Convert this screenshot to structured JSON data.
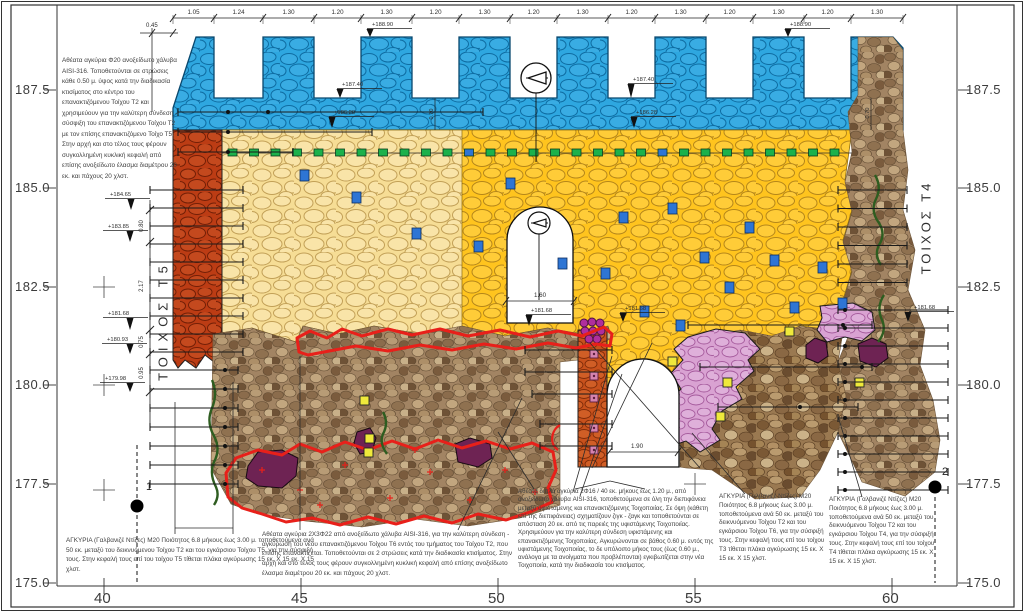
{
  "drawing": {
    "type": "wall elevation restoration drawing",
    "wall_labels": {
      "left": "ΤΟΙΧΟΣ Τ5",
      "right": "ΤΟΙΧΟΣ Τ4"
    },
    "section_markers": [
      {
        "label": "1"
      },
      {
        "label": "2"
      }
    ]
  },
  "axes": {
    "left": [
      {
        "t": "187.5",
        "y": 90
      },
      {
        "t": "185.0",
        "y": 188
      },
      {
        "t": "182.5",
        "y": 287
      },
      {
        "t": "180.0",
        "y": 385
      },
      {
        "t": "177.5",
        "y": 484
      },
      {
        "t": "175.0",
        "y": 583
      }
    ],
    "right": [
      {
        "t": "187.5",
        "y": 90
      },
      {
        "t": "185.0",
        "y": 188
      },
      {
        "t": "182.5",
        "y": 287
      },
      {
        "t": "180.0",
        "y": 385
      },
      {
        "t": "177.5",
        "y": 484
      },
      {
        "t": "175.0",
        "y": 583
      }
    ],
    "bottom": [
      {
        "t": "40",
        "x": 104
      },
      {
        "t": "45",
        "x": 301
      },
      {
        "t": "50",
        "x": 498
      },
      {
        "t": "55",
        "x": 695
      },
      {
        "t": "60",
        "x": 892
      }
    ]
  },
  "top_dimension_row": {
    "y": 18,
    "start_x": 173,
    "segments": [
      {
        "t": "1.05",
        "w": 41
      },
      {
        "t": "1.24",
        "w": 49
      },
      {
        "t": "1.30",
        "w": 51
      },
      {
        "t": "1.20",
        "w": 47
      },
      {
        "t": "1.30",
        "w": 51
      },
      {
        "t": "1.20",
        "w": 47
      },
      {
        "t": "1.30",
        "w": 51
      },
      {
        "t": "1.20",
        "w": 47
      },
      {
        "t": "1.30",
        "w": 51
      },
      {
        "t": "1.20",
        "w": 47
      },
      {
        "t": "1.30",
        "w": 51
      },
      {
        "t": "1.20",
        "w": 47
      },
      {
        "t": "1.30",
        "w": 51
      },
      {
        "t": "1.20",
        "w": 47
      },
      {
        "t": "1.30",
        "w": 52
      }
    ]
  },
  "misc_dims": {
    "d045": {
      "t": "0.45",
      "x": 146,
      "y": 27
    },
    "d160": {
      "t": "1.60",
      "x": 540,
      "y": 297,
      "x1": 506,
      "x2": 574,
      "ly": 301
    },
    "d190": {
      "t": "1.90",
      "x": 637,
      "y": 448,
      "x1": 609,
      "x2": 678,
      "ly": 452
    },
    "d070a": {
      "t": "0.70",
      "x": 433,
      "y": 114
    },
    "d070b": {
      "t": "0.70",
      "x": 869,
      "y": 113
    }
  },
  "left_dim_chain": {
    "x": 150,
    "y_top": 200,
    "y_bot": 424,
    "ticks": [
      210,
      242,
      330,
      354,
      392
    ],
    "labels": [
      {
        "t": "0.80",
        "y": 226
      },
      {
        "t": "2.17",
        "y": 286
      },
      {
        "t": "0.75",
        "y": 342
      },
      {
        "t": "0.95",
        "y": 373
      }
    ]
  },
  "elevation_markers": [
    {
      "t": "+188.90",
      "x": 372,
      "y": 26,
      "ax": 370,
      "ay": 37
    },
    {
      "t": "+188.90",
      "x": 790,
      "y": 26,
      "ax": 788,
      "ay": 37
    },
    {
      "t": "+187.40",
      "x": 342,
      "y": 86,
      "ax": 340,
      "ay": 98
    },
    {
      "t": "+187.40",
      "x": 633,
      "y": 81,
      "ax": 631,
      "ay": 98
    },
    {
      "t": "+186.28",
      "x": 334,
      "y": 114,
      "ax": 332,
      "ay": 128
    },
    {
      "t": "+186.28",
      "x": 636,
      "y": 114,
      "ax": 634,
      "ay": 128
    },
    {
      "t": "+184.65",
      "x": 110,
      "y": 196,
      "ax": 131,
      "ay": 210
    },
    {
      "t": "+183.85",
      "x": 108,
      "y": 228,
      "ax": 130,
      "ay": 242
    },
    {
      "t": "+181.68",
      "x": 108,
      "y": 315,
      "ax": 130,
      "ay": 330
    },
    {
      "t": "+180.93",
      "x": 107,
      "y": 341,
      "ax": 130,
      "ay": 354
    },
    {
      "t": "+179.98",
      "x": 105,
      "y": 380,
      "ax": 130,
      "ay": 392
    },
    {
      "t": "+181.68",
      "x": 531,
      "y": 312,
      "ax": 529,
      "ay": 326
    },
    {
      "t": "+181.68",
      "x": 625,
      "y": 310,
      "ax": 623,
      "ay": 322
    },
    {
      "t": "+181.68",
      "x": 914,
      "y": 309,
      "ax": 908,
      "ay": 322
    }
  ],
  "anchor_sets": [
    {
      "name": "left-upper",
      "lines": [
        {
          "y": 112,
          "x1": 178,
          "x2": 483,
          "dots": [
            228,
            268
          ]
        },
        {
          "y": 132,
          "x1": 178,
          "x2": 372,
          "dots": [
            228
          ]
        },
        {
          "y": 152,
          "x1": 178,
          "x2": 293,
          "dots": [
            228
          ]
        }
      ]
    },
    {
      "name": "left-wall",
      "gen": {
        "y0": 190,
        "y1": 352,
        "step": 18,
        "x1": 150,
        "x2": 243
      }
    },
    {
      "name": "left-photo",
      "gen": {
        "y0": 370,
        "y1": 484,
        "step": 19,
        "x1": 150,
        "x2": 238,
        "dot": 225
      }
    },
    {
      "name": "right-wall-upper",
      "gen": {
        "y0": 190,
        "y1": 300,
        "step": 18.5,
        "x1": 838,
        "x2": 907
      }
    },
    {
      "name": "right-wall-lower",
      "gen": {
        "y0": 310,
        "y1": 492,
        "step": 18,
        "x1": 838,
        "x2": 948,
        "dot": 845
      }
    },
    {
      "name": "pink-zone",
      "lines": [
        {
          "y": 325,
          "x1": 688,
          "x2": 872,
          "dots": [
            843
          ]
        },
        {
          "y": 367,
          "x1": 700,
          "x2": 872,
          "dots": [
            862
          ]
        },
        {
          "y": 407,
          "x1": 718,
          "x2": 858,
          "dots": [
            800
          ]
        }
      ]
    },
    {
      "name": "column",
      "lines": [
        {
          "y": 350,
          "x1": 525,
          "x2": 612,
          "dots": []
        },
        {
          "y": 372,
          "x1": 525,
          "x2": 612,
          "dots": []
        },
        {
          "y": 394,
          "x1": 532,
          "x2": 612,
          "dots": []
        },
        {
          "y": 424,
          "x1": 540,
          "x2": 612,
          "dots": []
        },
        {
          "y": 446,
          "x1": 540,
          "x2": 612,
          "dots": []
        }
      ]
    }
  ],
  "anchor_squares": {
    "green_row": {
      "y": 149,
      "x_start": 228,
      "step": 21.5,
      "count": 29,
      "blue_indices": [
        11,
        20
      ]
    },
    "blue": [
      [
        300,
        170
      ],
      [
        352,
        192
      ],
      [
        412,
        228
      ],
      [
        474,
        241
      ],
      [
        506,
        178
      ],
      [
        558,
        258
      ],
      [
        601,
        268
      ],
      [
        619,
        212
      ],
      [
        668,
        203
      ],
      [
        700,
        252
      ],
      [
        745,
        222
      ],
      [
        790,
        302
      ],
      [
        818,
        262
      ],
      [
        838,
        298
      ],
      [
        640,
        306
      ],
      [
        676,
        320
      ],
      [
        725,
        282
      ],
      [
        770,
        255
      ]
    ],
    "yellow": [
      [
        360,
        396
      ],
      [
        365,
        434
      ],
      [
        364,
        448
      ],
      [
        785,
        327
      ],
      [
        723,
        378
      ],
      [
        716,
        412
      ],
      [
        855,
        378
      ],
      [
        668,
        357
      ]
    ],
    "column_pink": {
      "x": 590,
      "ys": [
        350,
        372,
        394,
        424,
        446
      ]
    }
  },
  "red_marks": [
    [
      262,
      470
    ],
    [
      300,
      490
    ],
    [
      345,
      465
    ],
    [
      390,
      498
    ],
    [
      430,
      472
    ],
    [
      470,
      500
    ],
    [
      505,
      470
    ],
    [
      535,
      492
    ],
    [
      320,
      505
    ],
    [
      415,
      450
    ]
  ],
  "grid_crosses": [
    [
      104,
      287
    ],
    [
      104,
      385
    ],
    [
      104,
      490
    ],
    [
      695,
      484
    ],
    [
      892,
      287
    ],
    [
      892,
      385
    ]
  ],
  "annotations": [
    {
      "x": 62,
      "y": 56,
      "w": 118,
      "text": "Αθέατα αγκύρια Φ20 ανοξείδωτο χάλυβα AISI-316. Τοποθετούνται σε στρώσεις κάθε 0.50 μ. ύψος κατά την διαδικασία κτισίματος στο κέντρο του επανακτιζόμενου Τοίχου Τ2 και χρησιμεύουν για την καλύτερη σύνδεση - σύσφιξη του επανακτιζόμενου Τοίχου Τ2 με τον επίσης επανακτιζόμενο Τοίχο Τ5. Στην αρχή και στο τέλος τους φέρουν συγκολλημένη κυκλική κεφαλή από επίσης ανοξείδωτο έλασμα διαμέτρου 20 εκ. και πάχους 20 χλστ."
    },
    {
      "x": 66,
      "y": 536,
      "w": 254,
      "text": "ΑΓΚΥΡΙΑ (Γαλβανιζέ Ντίζες) Μ20 Ποιότητος 6.8 μήκους έως 3.00 μ. τοποθετούμενα ανά 50 εκ.  μεταξύ του δεικνυόμενου Τοίχου Τ2 και του εγκάρσιου Τοίχου Τ5, για την σύσφιξή τους. Στην κεφαλή τους επί του τοίχου Τ5 τίθεται πλάκα αγκύρωσης 15 εκ. Χ 15 εκ. Χ 15 χλστ."
    },
    {
      "x": 262,
      "y": 530,
      "w": 260,
      "text": "Αθέατα αγκύρια 2Χ3Φ22 από ανοξείδωτο χάλυβα AISI-316, για την καλύτερη σύνδεση - αγκύρωση του νέου επανακτιζόμενου Τοίχου Τ6 εντός του τμήματος του Τοίχου Τ2, που επίσης επανακτίζεται. Τοποθετούνται σε 2 στρώσεις  κατά την διαδικασία κτισίματος. Στην αρχή και στο τέλος τους φέρουν συγκολλημένη κυκλική κεφαλή από επίσης ανοξείδωτο έλασμα διαμέτρου 20 εκ. και πάχους 20 χλστ."
    },
    {
      "x": 518,
      "y": 488,
      "w": 198,
      "text": "Αθέατα διπλά αγκύρια 2Φ16 / 40 εκ. μήκους έως 1.20 μ., από ανοξείδωτο χάλυβα AISI-316, τοποθετούμενα σε όλη την διεπιφάνεια μεταξύ υφιστάμενης και επανακτιζόμενης Τοιχοποιίας. Σε όψη (κάθετη επί της διεπιφάνειας) σχηματίζουν ζιγκ - ζαγκ και τοποθετούνται σε απόσταση 20 εκ. από τις παρειές της υφιστάμενης Τοιχοποιίας. Χρησιμεύουν για την καλύτερη σύνδεση υφιστάμενης και επανακτιζόμενης Τοιχοποιίας. Αγκυρώνονται σε βάθος 0.60 μ. εντός της υφιστάμενης Τοιχοποιίας, το δε υπόλοιπο μήκος τους (έως 0.60 μ., ανάλογα με τα ανοίγματα που προβλέπονται) εγκιβωτίζεται στην νέα Τοιχοποιία, κατά την διαδικασία του κτισίματος."
    },
    {
      "x": 719,
      "y": 493,
      "w": 110,
      "text": "ΑΓΚΥΡΙΑ (Γαλβανιζέ Ντίζες) Μ20 Ποιότητος 6.8 μήκους έως 3.00 μ. τοποθετούμενα ανά 50 εκ.  μεταξύ του δεικνυόμενου Τοίχου Τ2  και του εγκάρσιου Τοίχου Τ6, για την σύσφιξή τους. Στην κεφαλή τους επί του τοίχου Τ3 τίθεται πλάκα αγκύρωσης 15 εκ. Χ 15 εκ. Χ 15 χλστ."
    },
    {
      "x": 829,
      "y": 496,
      "w": 108,
      "text": "ΑΓΚΥΡΙΑ (Γαλβανιζέ Ντίζες) Μ20 Ποιότητος 6.8 μήκους έως 3.00 μ. τοποθετούμενα ανά 50 εκ.  μεταξύ του δεικνυόμενου Τοίχου Τ2  και του εγκάρσιου Τοίχου Τ4, για την σύσφιξή τους. Στην κεφαλή τους επί του τοίχου Τ4 τίθεται πλάκα αγκύρωσης 15  εκ. Χ 15 εκ. Χ 15 χλστ."
    }
  ],
  "colors": {
    "crest_blue": "#2EA7E0",
    "new_masonry_yellow": "#FFC41E",
    "new_masonry_pale": "#F6DD95",
    "wall_t5_red": "#BC3C14",
    "column_orange": "#C8511C",
    "keep_pink": "#D9A2D2",
    "patch_purple": "#6E2353",
    "outline_red": "#E8201A",
    "anchor_green": "#1CB14B",
    "anchor_blue": "#2E75D4",
    "anchor_yellow": "#EFE93B",
    "vegetation_green": "#2E5D20"
  }
}
